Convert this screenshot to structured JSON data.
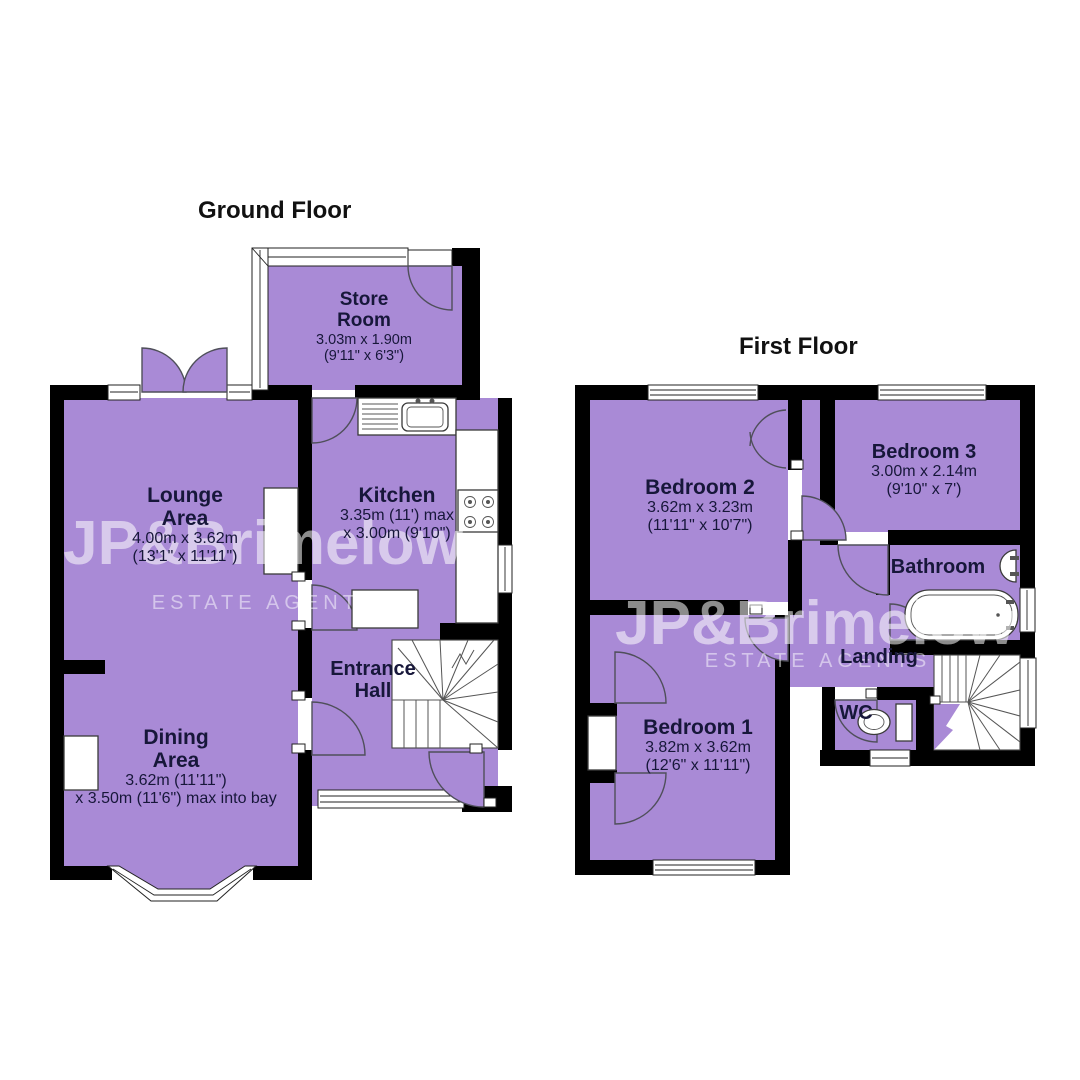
{
  "titles": {
    "ground": "Ground Floor",
    "first": "First Floor"
  },
  "watermark": {
    "brand": "JP&Brimelow",
    "tagline": "ESTATE AGENTS"
  },
  "colors": {
    "room_fill": "#a98ad6",
    "wall": "#000000",
    "label_text": "#17173a",
    "watermark": "#ffffff",
    "background": "#ffffff"
  },
  "rooms": {
    "store_room": {
      "name_line1": "Store",
      "name_line2": "Room",
      "dims_line1": "3.03m x 1.90m",
      "dims_line2": "(9'11\" x 6'3\")"
    },
    "lounge": {
      "name_line1": "Lounge",
      "name_line2": "Area",
      "dims_line1": "4.00m x 3.62m",
      "dims_line2": "(13'1\" x 11'11\")"
    },
    "kitchen": {
      "name_line1": "Kitchen",
      "dims_line1": "3.35m (11') max",
      "dims_line2": "x 3.00m (9'10\")"
    },
    "entrance_hall": {
      "name_line1": "Entrance",
      "name_line2": "Hall"
    },
    "dining": {
      "name_line1": "Dining",
      "name_line2": "Area",
      "dims_line1": "3.62m (11'11\")",
      "dims_line2": "x 3.50m (11'6\") max into bay"
    },
    "bedroom2": {
      "name_line1": "Bedroom 2",
      "dims_line1": "3.62m x 3.23m",
      "dims_line2": "(11'11\" x 10'7\")"
    },
    "bedroom3": {
      "name_line1": "Bedroom 3",
      "dims_line1": "3.00m x 2.14m",
      "dims_line2": "(9'10\" x 7')"
    },
    "bathroom": {
      "name_line1": "Bathroom"
    },
    "landing": {
      "name_line1": "Landing"
    },
    "wc": {
      "name_line1": "WC"
    },
    "bedroom1": {
      "name_line1": "Bedroom 1",
      "dims_line1": "3.82m x 3.62m",
      "dims_line2": "(12'6\" x 11'11\")"
    }
  }
}
